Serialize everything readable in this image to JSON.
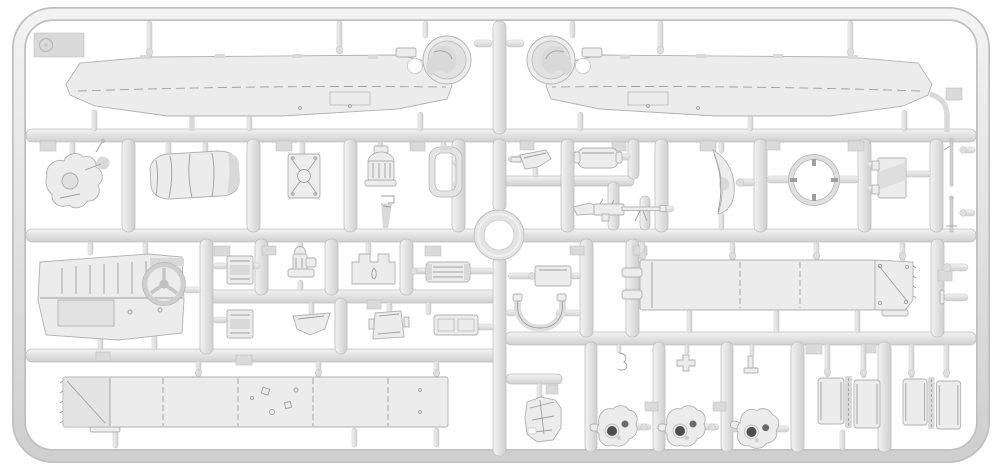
{
  "meta": {
    "subject": "injection-molded plastic model kit sprue photographed on a plain white background",
    "material_look": "light grey polystyrene with soft highlights and shadows",
    "orientation": "landscape",
    "visible_text": "none (only an embossed circular stamp on the top-left corner tab)"
  },
  "palette": {
    "bg": "#ffffff",
    "runner": "#e2e2e2",
    "runner-hi": "#f2f2f2",
    "runner-lo": "#cdcdcd",
    "runner-edge": "#bfbfbf",
    "part-fill": "#ececec",
    "part-edge": "#b1b1b1",
    "part-detail": "#9e9e9e",
    "part-shade": "#d9d9d9",
    "hole-dark": "#4e4e4e",
    "pad": "#dadada"
  },
  "sprue": {
    "frame": {
      "shape": "rounded-rectangle outer border",
      "corner_tab": {
        "position": "top-left",
        "mark": "embossed circle stamp"
      }
    },
    "runners": {
      "horizontal_full": 3,
      "horizontal_partial": 4,
      "vertical_segments": 24,
      "center_feature": "circular ring where the central runners cross",
      "gates": "short tapered pins with bulbs connecting parts to runners",
      "ejector_pads": "small square tabs scattered along runners"
    },
    "parts": [
      {
        "id": "hull-panel-left",
        "name": "long fender/hull half with circular fan housing",
        "count": 1
      },
      {
        "id": "hull-panel-right",
        "name": "mirrored fender/hull half with circular fan housing",
        "count": 1
      },
      {
        "id": "center-ring",
        "name": "large ring at runner crossing",
        "count": 1
      },
      {
        "id": "bracket-mount",
        "name": "irregular gun-cradle bracket",
        "count": 1
      },
      {
        "id": "tarp-roll",
        "name": "rolled canvas tarpaulin",
        "count": 1
      },
      {
        "id": "x-braced-plate",
        "name": "small plate with X bracing and hub",
        "count": 1
      },
      {
        "id": "air-filter",
        "name": "domed cylindrical filter on base",
        "count": 1
      },
      {
        "id": "strap-bracket",
        "name": "tiny bracket with hanging strap",
        "count": 1
      },
      {
        "id": "hatch-frame-ring",
        "name": "rounded rectangular frame",
        "count": 1
      },
      {
        "id": "funnel",
        "name": "small funnel / scoop",
        "count": 1
      },
      {
        "id": "fuel-tank-box",
        "name": "rounded rectangular tank",
        "count": 1
      },
      {
        "id": "machine-gun",
        "name": "machine gun with stock and barrel",
        "count": 1
      },
      {
        "id": "gun-shield",
        "name": "curved crescent shield",
        "count": 1
      },
      {
        "id": "turret-ring",
        "name": "open ring with inner tick lugs",
        "count": 1
      },
      {
        "id": "transfer-case-box",
        "name": "small rectangular case with side tabs",
        "count": 1
      },
      {
        "id": "antenna-rod",
        "name": "thin rod / lever",
        "count": 2
      },
      {
        "id": "firewall-panel",
        "name": "cab firewall panel with steering wheel",
        "count": 1
      },
      {
        "id": "stowage-box",
        "name": "small stowage box",
        "count": 2
      },
      {
        "id": "engine-pump",
        "name": "small pump/engine fitting",
        "count": 1
      },
      {
        "id": "notched-seat-plate",
        "name": "castellated plate",
        "count": 1
      },
      {
        "id": "ribbed-grille-plate",
        "name": "ribbed rectangular plate",
        "count": 2
      },
      {
        "id": "tray",
        "name": "shallow trapezoid tray",
        "count": 1
      },
      {
        "id": "mount-plate",
        "name": "square mounting plate with wings",
        "count": 1
      },
      {
        "id": "small-plate-right",
        "name": "plain small plate",
        "count": 1
      },
      {
        "id": "saddle-clamp",
        "name": "U-shaped saddle clamp",
        "count": 1
      },
      {
        "id": "bed-side-panel-right",
        "name": "long cargo-bed side panel with diagonal brace (right end)",
        "count": 1
      },
      {
        "id": "bed-side-panel-bottom",
        "name": "long cargo-bed side panel with diagonal brace (left end)",
        "count": 1
      },
      {
        "id": "crumpled-seat",
        "name": "small crumpled cushion part",
        "count": 1
      },
      {
        "id": "axle-hub",
        "name": "axle/gearbox housing with two dark bores",
        "count": 3
      },
      {
        "id": "hinged-hood",
        "name": "pair of hood panels joined by hinge strip",
        "count": 2
      },
      {
        "id": "hook-fitting",
        "name": "small hook",
        "count": 1
      },
      {
        "id": "cross-fitting",
        "name": "small plus-shaped fitting",
        "count": 1
      },
      {
        "id": "tee-bracket",
        "name": "small T bracket",
        "count": 1
      },
      {
        "id": "gear-lever",
        "name": "lever rod with ball knob",
        "count": 2
      }
    ]
  }
}
